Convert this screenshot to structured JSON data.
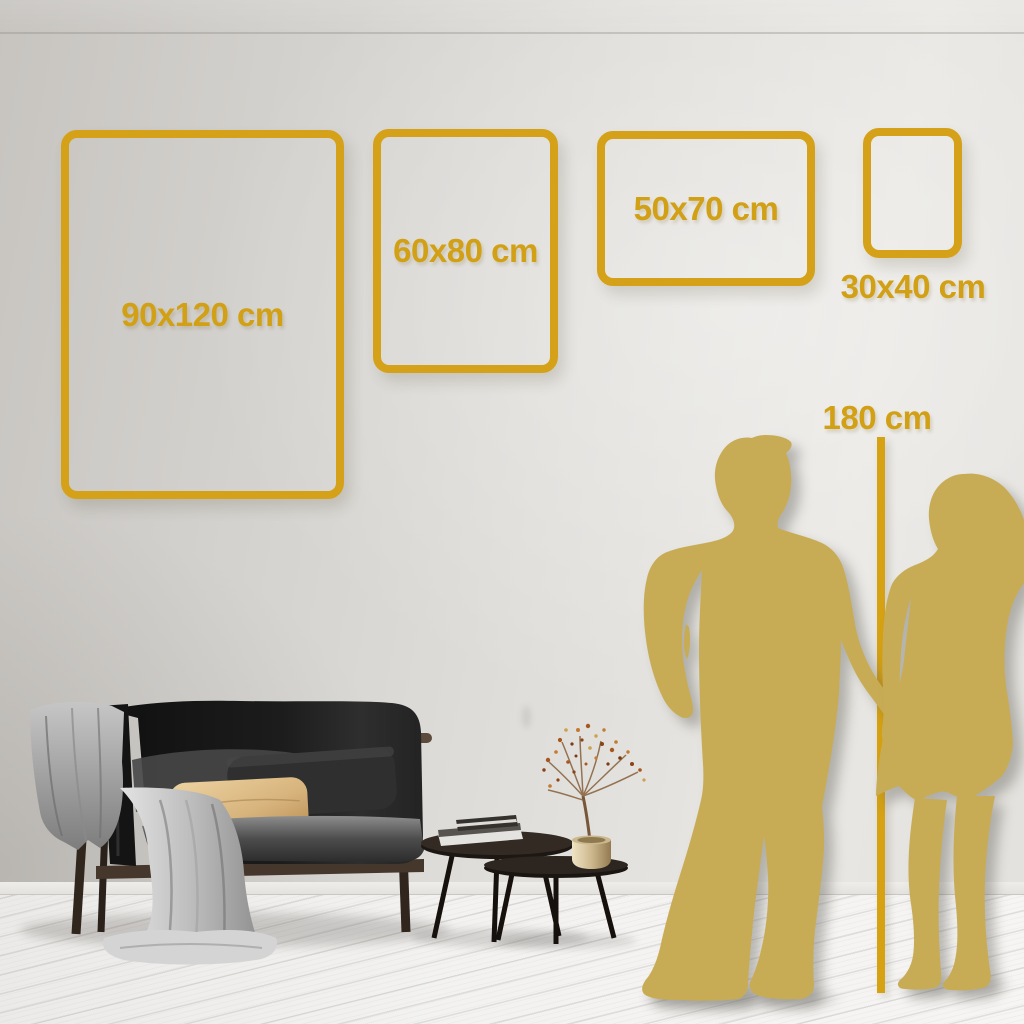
{
  "palette": {
    "accent_gold": "#D5A118",
    "line_gold": "#D6A112",
    "silhouette_gold": "#C8AC55",
    "wall_light": "#E9E7E3",
    "wall_dark": "#C7C4C0",
    "floor_white": "#F3F2F0"
  },
  "size_guide": {
    "frames": [
      {
        "label": "90x120 cm",
        "width_cm": 90,
        "height_cm": 120
      },
      {
        "label": "60x80 cm",
        "width_cm": 60,
        "height_cm": 80
      },
      {
        "label": "50x70 cm",
        "width_cm": 50,
        "height_cm": 70
      },
      {
        "label": "30x40 cm",
        "width_cm": 30,
        "height_cm": 40
      }
    ],
    "height_marker": {
      "label": "180 cm",
      "value_cm": 180
    }
  },
  "scene_objects": [
    "dark-sofa-with-blanket",
    "tan-pillow",
    "gray-pillow",
    "nesting-coffee-tables",
    "book-stack",
    "brass-vase-dried-branch",
    "couple-silhouette-holding-hands",
    "height-reference-line"
  ]
}
